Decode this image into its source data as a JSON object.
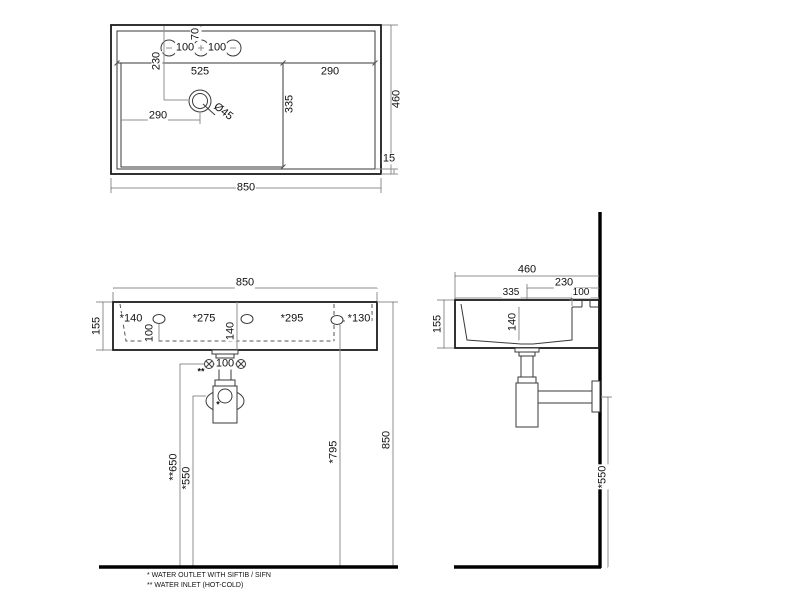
{
  "tv": {
    "width": "850",
    "depth": "460",
    "rim": "15",
    "basin_width": "525",
    "deck_width": "290",
    "basin_depth": "335",
    "drain_from_left": "290",
    "drain_from_back": "230",
    "holes_from_back": "70",
    "hole_gap_left": "100",
    "hole_gap_right": "100",
    "drain_diameter": "Ø45"
  },
  "fv": {
    "width": "850",
    "height": "155",
    "gap1": "*140",
    "gap2": "*275",
    "gap3": "*295",
    "gap4": "*130",
    "hole_height_left": "100",
    "hole_height_mid": "140",
    "inlet_gap": "100",
    "inlet_mark": "**",
    "outlet_mark": "*",
    "inlet_height": "**650",
    "outlet_height": "*550",
    "side_hole_height": "*795",
    "rim_height": "850"
  },
  "sv": {
    "depth": "460",
    "drain_to_wall": "230",
    "basin_depth": "335",
    "hole_to_wall": "100",
    "height": "155",
    "inner_depth": "140",
    "outlet_height": "*550"
  },
  "notes": {
    "outlet": "* WATER OUTLET WITH SIFTIB / SIFN",
    "inlet": "** WATER INLET (HOT-COLD)"
  }
}
